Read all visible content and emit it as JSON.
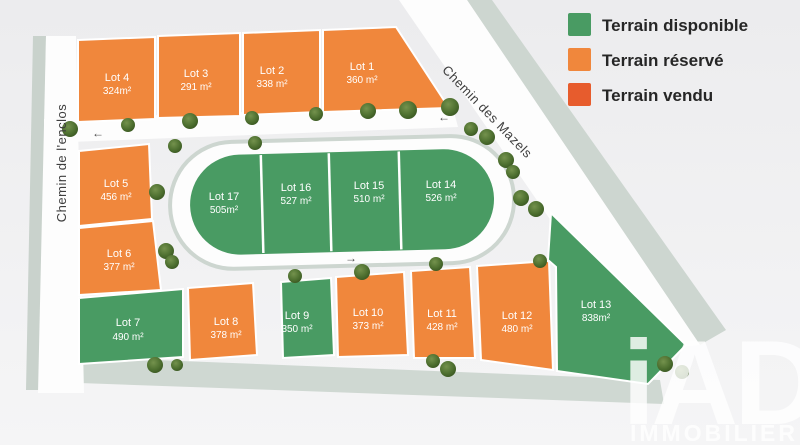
{
  "legend": {
    "items": [
      {
        "label": "Terrain disponible",
        "color": "#499b63",
        "status": "available"
      },
      {
        "label": "Terrain réservé",
        "color": "#f0873c",
        "status": "reserved"
      },
      {
        "label": "Terrain vendu",
        "color": "#e75c2d",
        "status": "sold"
      }
    ]
  },
  "roads": {
    "left_road": "Chemin de l'enclos",
    "diagonal_road": "Chemin des Mazels"
  },
  "colors": {
    "available": "#499b63",
    "reserved": "#f0873c",
    "sold": "#e75c2d",
    "road": "#fdfdfd",
    "road_edge": "#cdd6d0",
    "verge": "#cfd8d2",
    "background": "#efeff0"
  },
  "icons": {
    "arrow_left": "←",
    "arrow_right": "→"
  },
  "lots": [
    {
      "name": "Lot 1",
      "area": "360 m²",
      "status": "reserved"
    },
    {
      "name": "Lot 2",
      "area": "338 m²",
      "status": "reserved"
    },
    {
      "name": "Lot 3",
      "area": "291 m²",
      "status": "reserved"
    },
    {
      "name": "Lot 4",
      "area": "324m²",
      "status": "reserved"
    },
    {
      "name": "Lot 5",
      "area": "456 m²",
      "status": "reserved"
    },
    {
      "name": "Lot 6",
      "area": "377 m²",
      "status": "reserved"
    },
    {
      "name": "Lot 7",
      "area": "490 m²",
      "status": "available"
    },
    {
      "name": "Lot 8",
      "area": "378 m²",
      "status": "reserved"
    },
    {
      "name": "Lot 9",
      "area": "350 m²",
      "status": "available"
    },
    {
      "name": "Lot 10",
      "area": "373 m²",
      "status": "reserved"
    },
    {
      "name": "Lot 11",
      "area": "428 m²",
      "status": "reserved"
    },
    {
      "name": "Lot 12",
      "area": "480 m²",
      "status": "reserved"
    },
    {
      "name": "Lot 13",
      "area": "838m²",
      "status": "available"
    },
    {
      "name": "Lot 14",
      "area": "526 m²",
      "status": "available"
    },
    {
      "name": "Lot 15",
      "area": "510 m²",
      "status": "available"
    },
    {
      "name": "Lot 16",
      "area": "527 m²",
      "status": "available"
    },
    {
      "name": "Lot 17",
      "area": "505m²",
      "status": "available"
    }
  ],
  "watermark": {
    "brand": "iAD",
    "subtitle": "IMMOBILIER"
  }
}
